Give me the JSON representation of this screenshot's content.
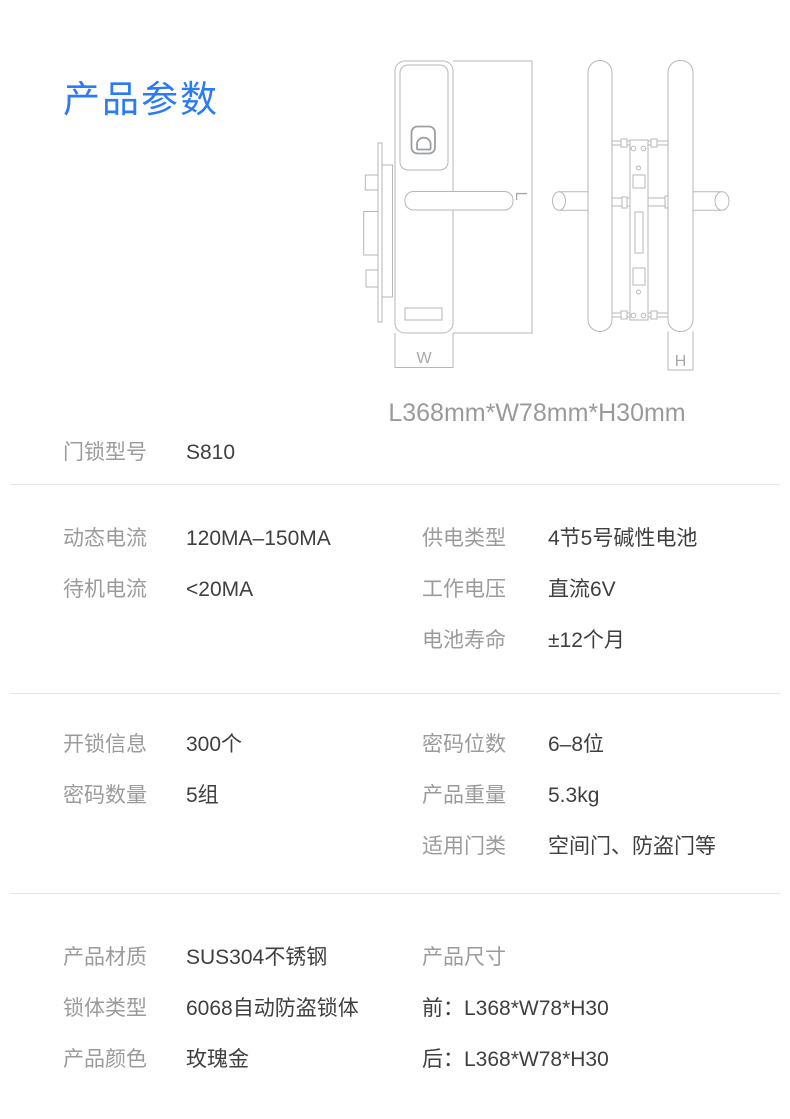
{
  "title": "产品参数",
  "colors": {
    "accent_blue": "#2b7bf6",
    "label_gray": "#9b9b9b",
    "value_dark": "#3f3f3f",
    "drawing_line_gray": "#b5b8ba",
    "divider_gray": "#e6e6e6"
  },
  "diagram": {
    "caption": "L368mm*W78mm*H30mm",
    "labels": {
      "width": "W",
      "length": "L",
      "height": "H"
    }
  },
  "specs": {
    "model": {
      "label": "门锁型号",
      "value": "S810"
    },
    "sections": [
      {
        "left": [
          {
            "label": "动态电流",
            "value": "120MA–150MA"
          },
          {
            "label": "待机电流",
            "value": "<20MA"
          }
        ],
        "right": [
          {
            "label": "供电类型",
            "value": "4节5号碱性电池"
          },
          {
            "label": "工作电压",
            "value": "直流6V"
          },
          {
            "label": "电池寿命",
            "value": "±12个月"
          }
        ]
      },
      {
        "left": [
          {
            "label": "开锁信息",
            "value": "300个"
          },
          {
            "label": "密码数量",
            "value": "5组"
          }
        ],
        "right": [
          {
            "label": "密码位数",
            "value": "6–8位"
          },
          {
            "label": "产品重量",
            "value": "5.3kg"
          },
          {
            "label": "适用门类",
            "value": "空间门、防盗门等"
          }
        ]
      },
      {
        "left": [
          {
            "label": "产品材质",
            "value": "SUS304不锈钢"
          },
          {
            "label": "锁体类型",
            "value": "6068自动防盗锁体"
          },
          {
            "label": "产品颜色",
            "value": "玫瑰金"
          }
        ],
        "right": [
          {
            "label": "产品尺寸",
            "value": ""
          },
          {
            "label": "",
            "value": "前：L368*W78*H30"
          },
          {
            "label": "",
            "value": "后：L368*W78*H30"
          }
        ]
      }
    ]
  }
}
